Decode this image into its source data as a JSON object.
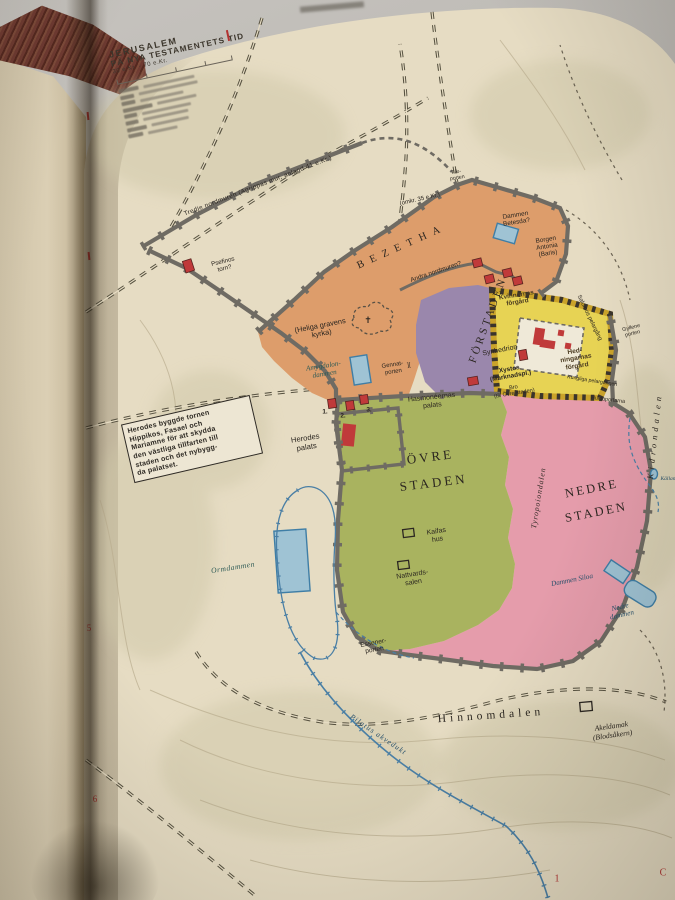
{
  "book": {
    "left_page": {
      "fragments": [
        "rna k",
        "las söde",
        "n ett vis",
        "n på sa",
        "ren (Ja",
        "ra landa",
        "al bjuda",
        "dagar lika",
        "ort i sin b",
        "ort, kom",
        "inga timm",
        "nde skugg",
        "lippa. Un",
        "a tonern",
        "sa, en avsk",
        "en stor allts",
        "till garn so",
        "amiljens kläd",
        "ade mycket f",
        "n blivit låg",
        "ången Israels",
        "ovade landet",
        "nd den enkla",
        "n alltjämt",
        "alades? I Nas",
        "ga landet anv",
        "de flesta mä",
        ". Vid tidpun",
        "m ett",
        "lmänt bruk. L",
        "dan på den tid",
        "babyloniska få",
        "gängse språke",
        "larna förstod",
        "g hebreiska, e",
        "men i hemm",
        "ska herraväl",
        "de en del lat",
        ", som löpte",
        "till söder, ku",
        "språk och d"
      ]
    }
  },
  "map": {
    "title_line1": "JERUSALEM",
    "title_line2": "PÅ NYA TESTAMENTETS TID",
    "subtitle": "30 e.Kr. - 70 e.Kr.",
    "legend": {
      "row_widths": [
        [
          20,
          52
        ],
        [
          14,
          60
        ],
        [
          14,
          44
        ],
        [
          30,
          40
        ],
        [
          13,
          50
        ],
        [
          13,
          46
        ],
        [
          20,
          38
        ],
        [
          15,
          30
        ]
      ]
    },
    "note_box": "Herodes byggde tornen\nHippikos, Fasael och\nMariamne för att skydda\nden västliga tillfarten till\nstaden och det nybygg-\nda palatset.",
    "labels": {
      "tredje_nordmuren": "Tredje nordmuren (Agrippas mur, anlagd 41 e.Kr.)",
      "psefinos_torn": "Psefinos\ntorn?",
      "bezetha": "BEZETHA",
      "omkr_35": "(omkr. 35 e.Kr.)",
      "far_porten": "Får-\nporten",
      "dammen_betesda": "Dammen\nBetesda?",
      "borgen_antonia": "Borgen\nAntonia\n(Baris)",
      "andra_nordmuren": "Andra nordmuren?",
      "kvinnornas_forgard": "Kvinnornas\nförgård",
      "salomos_pelargang": "Salomos pelargång",
      "gyllene_porten": "Gyllene\nporten",
      "hedningarnas_forgard": "Hed-\nningarnas\nförgård",
      "kungliga_pelargangen": "Kungliga pelargången",
      "huldaportarna": "Huldaportarna",
      "synhedrion": "Synhedrion",
      "xystos": "Xystos\n(Marknadspl.)",
      "bro_ovre_staden": "Bro\n(till Övre staden)",
      "hasmoneernas_palats": "Hasmonéernas\npalats",
      "heliga_gravens_kyrka": "(Heliga gravens\nkyrka)",
      "church_cross": "✝",
      "amygdalondammen": "Amygdalon-\ndammen",
      "gennat_porten": "Gennat-\nporten",
      "gate_glyph": "][",
      "forstaden": "FÖRSTADEN",
      "herodes_palats": "Herodes\npalats",
      "tower_1": "1.",
      "tower_2": "2.",
      "tower_3": "3.",
      "ovre_staden": "ÖVRE\nSTADEN",
      "kaifas_hus": "Kaifas\nhus",
      "nattvardssalen": "Nattvards-\nsalen",
      "nedre_staden": "NEDRE\nSTADEN",
      "tyropoiondalen": "Tyropoiondalen",
      "dammen_siloa": "Dammen Siloa",
      "nedre_dammen": "Nedre\ndammen",
      "kidrondalen": "Kidrondalen",
      "kallan": "Källan",
      "ormdammen": "Ormdammen",
      "essenerporten": "Essener-\nporten",
      "hinnomdalen": "Hinnomdalen",
      "akeldamak": "Akeldamak\n(Blodsåkern)",
      "pilatus_akvedukt": "Pilatus akvedukt"
    },
    "grid_marks": {
      "left_top": "5",
      "left_bottom": "6",
      "bottom_1": "1",
      "bottom_c": "C"
    },
    "colors": {
      "page": "#e6dcc3",
      "left_page": "#d8ccb1",
      "bezetha_orange": "#dd9d6b",
      "forstaden_purple": "#9a87ac",
      "temple_yellow": "#e7d354",
      "ovre_green": "#a9b35f",
      "nedre_pink": "#e59cab",
      "water_fill": "#9fc3d4",
      "water_line": "#3f7ea6",
      "wall_gray": "#6f6b63",
      "tower_red": "#c03a3a",
      "terrain_blotch": "#cfc7a8"
    }
  }
}
